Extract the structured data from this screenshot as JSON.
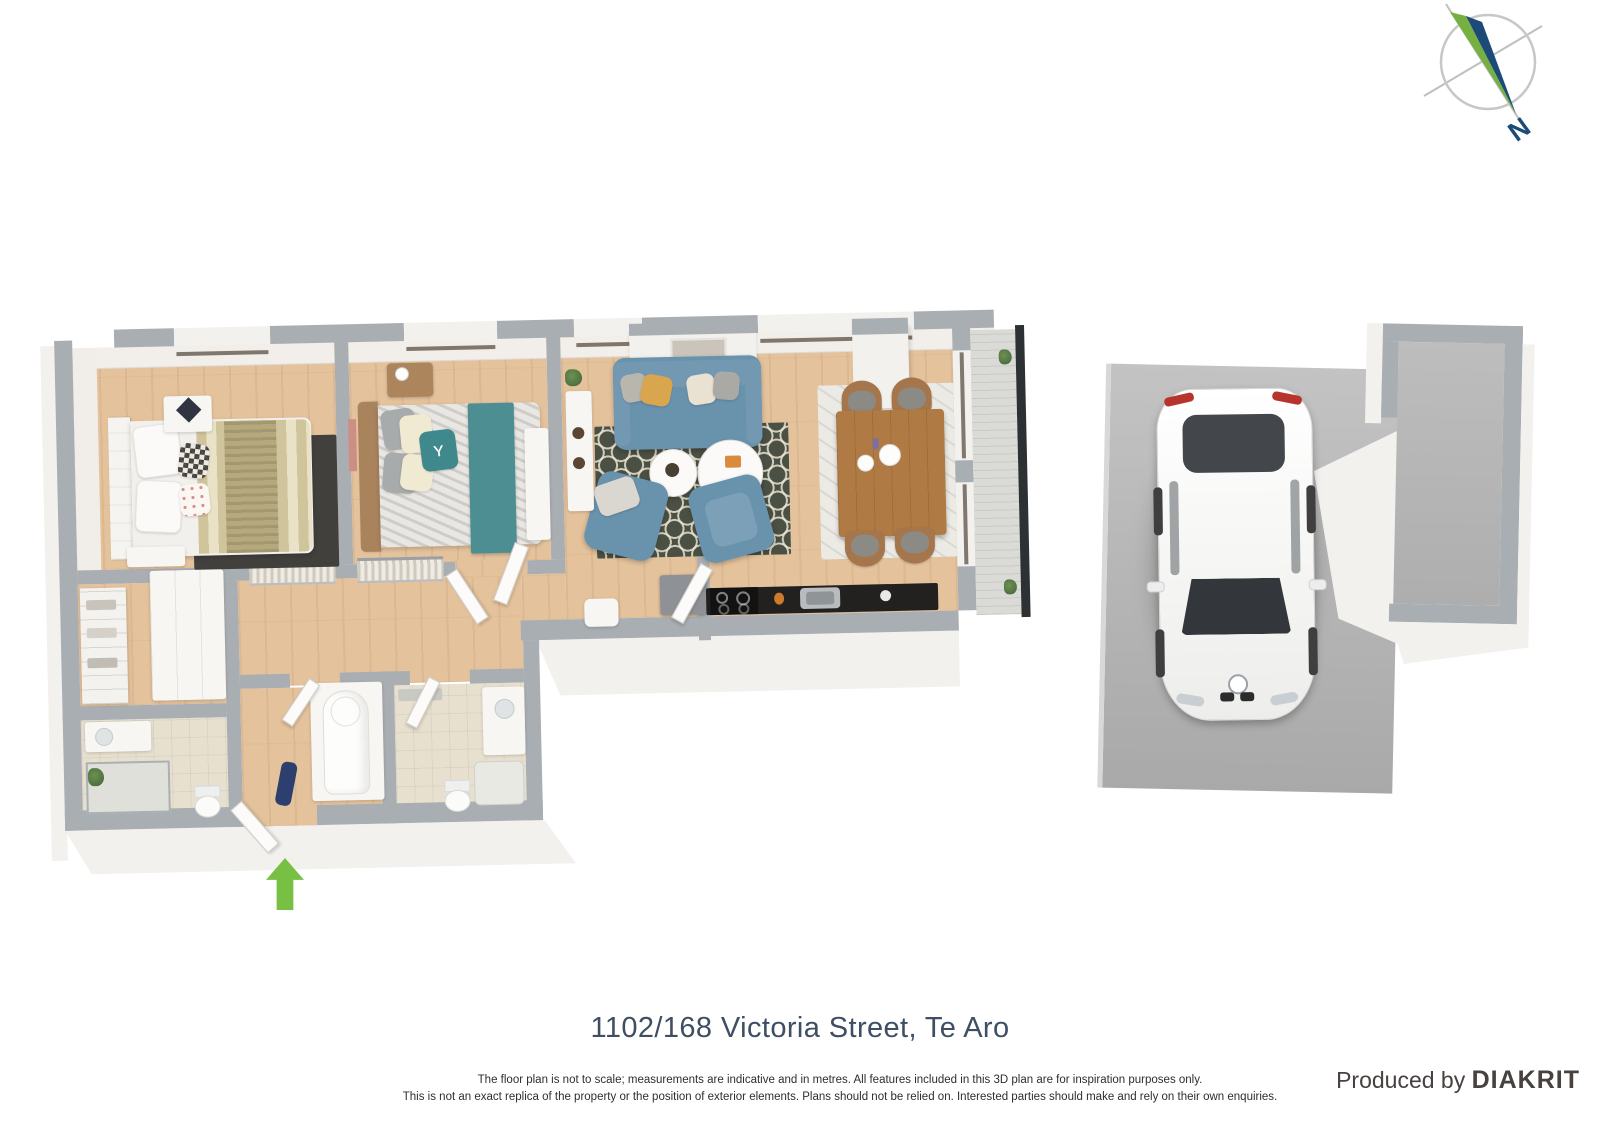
{
  "compass": {
    "label_n": "N"
  },
  "footer": {
    "title": "1102/168 Victoria Street, Te Aro",
    "disclaimer_line1": "The floor plan is not to scale; measurements are indicative and in metres. All features included in this 3D plan are for inspiration purposes only.",
    "disclaimer_line2": "This is not an exact replica of the property or the position of exterior elements. Plans should not be relied on. Interested parties should make and rely on their own enquiries.",
    "produced_by": "Produced by",
    "brand": "DIAKRIT"
  },
  "colors": {
    "wall_gray": "#a9aeb2",
    "floor_wood": "#e4c29c",
    "sofa_blue": "#6992ad",
    "rug_olive": "#4b5044",
    "bed_teal": "#4c8e92",
    "entry_arrow_green": "#77c044",
    "compass_green": "#76b043",
    "compass_navy": "#1d4b77",
    "title_color": "#3e4f63",
    "concrete_gray": "#b5b5b5",
    "railing_dark": "#2e3134"
  },
  "icons": {
    "compass": "compass-icon",
    "entry_arrow": "entry-arrow-icon"
  }
}
